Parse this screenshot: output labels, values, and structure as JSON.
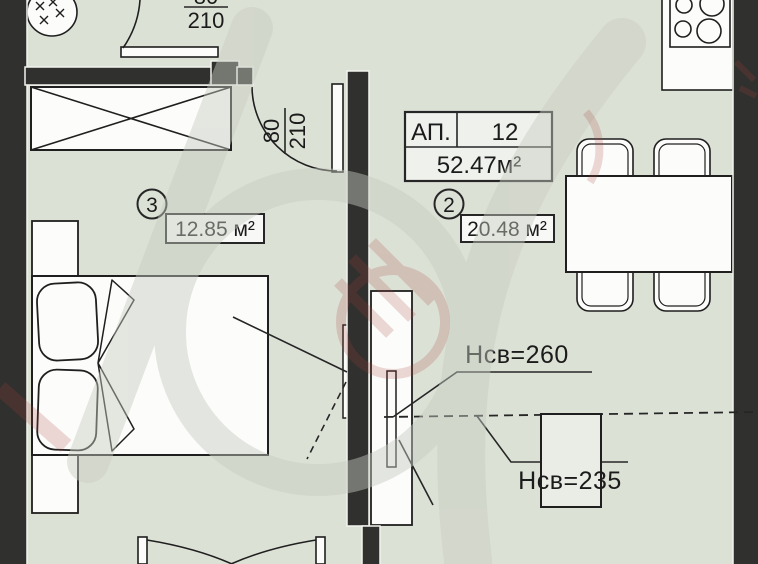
{
  "title": "Apartment floor plan",
  "plan": {
    "apartment": {
      "label": "АП.",
      "number": "12",
      "total_area": "52.47м²"
    },
    "rooms": [
      {
        "number": "2",
        "area": "20.48 м²"
      },
      {
        "number": "3",
        "area": "12.85 м²"
      }
    ],
    "clear_heights": [
      "Нсв=260",
      "Нсв=235"
    ],
    "doors": [
      {
        "width": "80",
        "height": "210"
      },
      {
        "width": "80",
        "height": "210"
      }
    ]
  },
  "colors": {
    "wall": "#30302e",
    "floor": "#dce1d6",
    "line": "#222222",
    "fixture_white": "#fcfcfa",
    "watermark_grey": "#c7cdc2",
    "watermark_red": "#a8413c"
  }
}
